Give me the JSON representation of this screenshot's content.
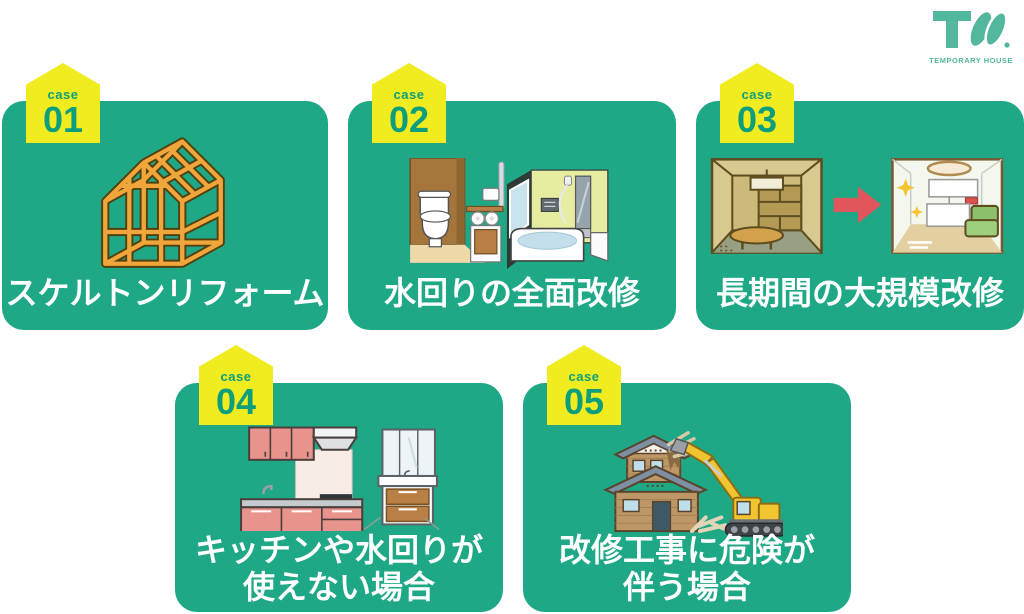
{
  "logo": {
    "monogram": "TW",
    "name": "TEMPORARY HOUSE",
    "color": "#53b79d",
    "icon": "tw-monogram-icon"
  },
  "colors": {
    "card_green": "#1fa886",
    "badge_yellow": "#f1ec1f",
    "badge_text_green": "#0d9f7b",
    "title_white": "#ffffff",
    "arrow_red": "#e0565c",
    "frame_orange": "#f0a63b",
    "excavator_yellow": "#f2c430"
  },
  "cards": [
    {
      "case_label": "case",
      "number": "01",
      "title_line1": "スケルトンリフォーム",
      "title_line2": "",
      "icon": "house-skeleton-frame-illustration"
    },
    {
      "case_label": "case",
      "number": "02",
      "title_line1": "水回りの全面改修",
      "title_line2": "",
      "icon": "toilet-and-bathroom-illustration"
    },
    {
      "case_label": "case",
      "number": "03",
      "title_line1": "長期間の大規模改修",
      "title_line2": "",
      "icon": "room-before-after-illustration"
    },
    {
      "case_label": "case",
      "number": "04",
      "title_line1": "キッチンや水回りが",
      "title_line2": "使えない場合",
      "icon": "kitchen-and-vanity-illustration"
    },
    {
      "case_label": "case",
      "number": "05",
      "title_line1": "改修工事に危険が",
      "title_line2": "伴う場合",
      "icon": "house-demolition-excavator-illustration"
    }
  ]
}
